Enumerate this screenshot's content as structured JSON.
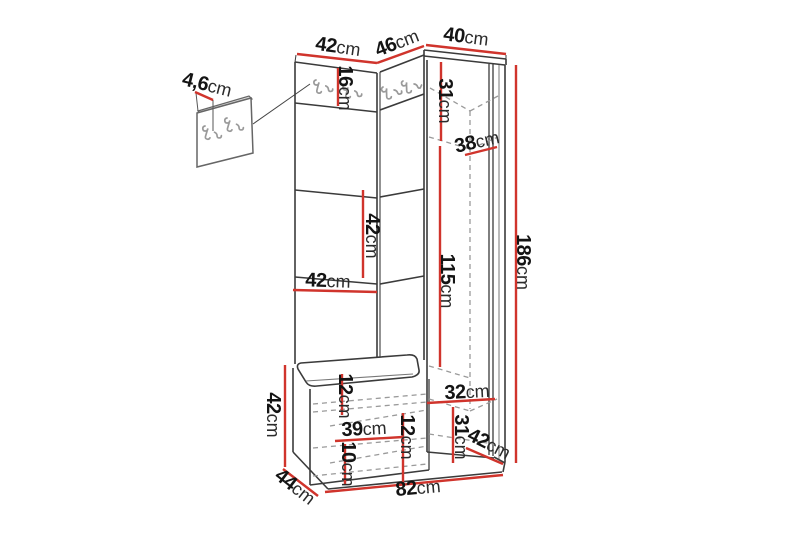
{
  "diagram": {
    "type": "furniture-dimension-diagram",
    "subject": "corner hallway unit with coat hooks, bench and tall cabinet",
    "unit_default": "cm",
    "colors": {
      "outline": "#3b3b3b",
      "hidden_edge": "#9a9a9a",
      "dimension_line": "#d0342c",
      "background": "#ffffff"
    },
    "dimensions": {
      "top_left_width": {
        "value": "42",
        "unit": "cm"
      },
      "top_middle_width": {
        "value": "46",
        "unit": "cm"
      },
      "top_right_width": {
        "value": "40",
        "unit": "cm"
      },
      "panel_thickness": {
        "value": "4,6",
        "unit": "cm"
      },
      "hook_panel_height": {
        "value": "16",
        "unit": "cm"
      },
      "cabinet_top_section_height": {
        "value": "31",
        "unit": "cm"
      },
      "shelf_depth": {
        "value": "38",
        "unit": "cm"
      },
      "total_height": {
        "value": "186",
        "unit": "cm"
      },
      "door_section_height": {
        "value": "115",
        "unit": "cm"
      },
      "middle_panel_height": {
        "value": "42",
        "unit": "cm"
      },
      "middle_panel_width": {
        "value": "42",
        "unit": "cm"
      },
      "bench_height": {
        "value": "42",
        "unit": "cm"
      },
      "seat_clearance": {
        "value": "12",
        "unit": "cm"
      },
      "bench_opening_width": {
        "value": "39",
        "unit": "cm"
      },
      "bench_inner_height": {
        "value": "12",
        "unit": "cm"
      },
      "plinth_height": {
        "value": "10",
        "unit": "cm"
      },
      "cabinet_bottom_width": {
        "value": "32",
        "unit": "cm"
      },
      "cabinet_bottom_section_height": {
        "value": "31",
        "unit": "cm"
      },
      "cabinet_depth": {
        "value": "42",
        "unit": "cm"
      },
      "bench_depth": {
        "value": "44",
        "unit": "cm"
      },
      "total_width": {
        "value": "82",
        "unit": "cm"
      }
    }
  }
}
